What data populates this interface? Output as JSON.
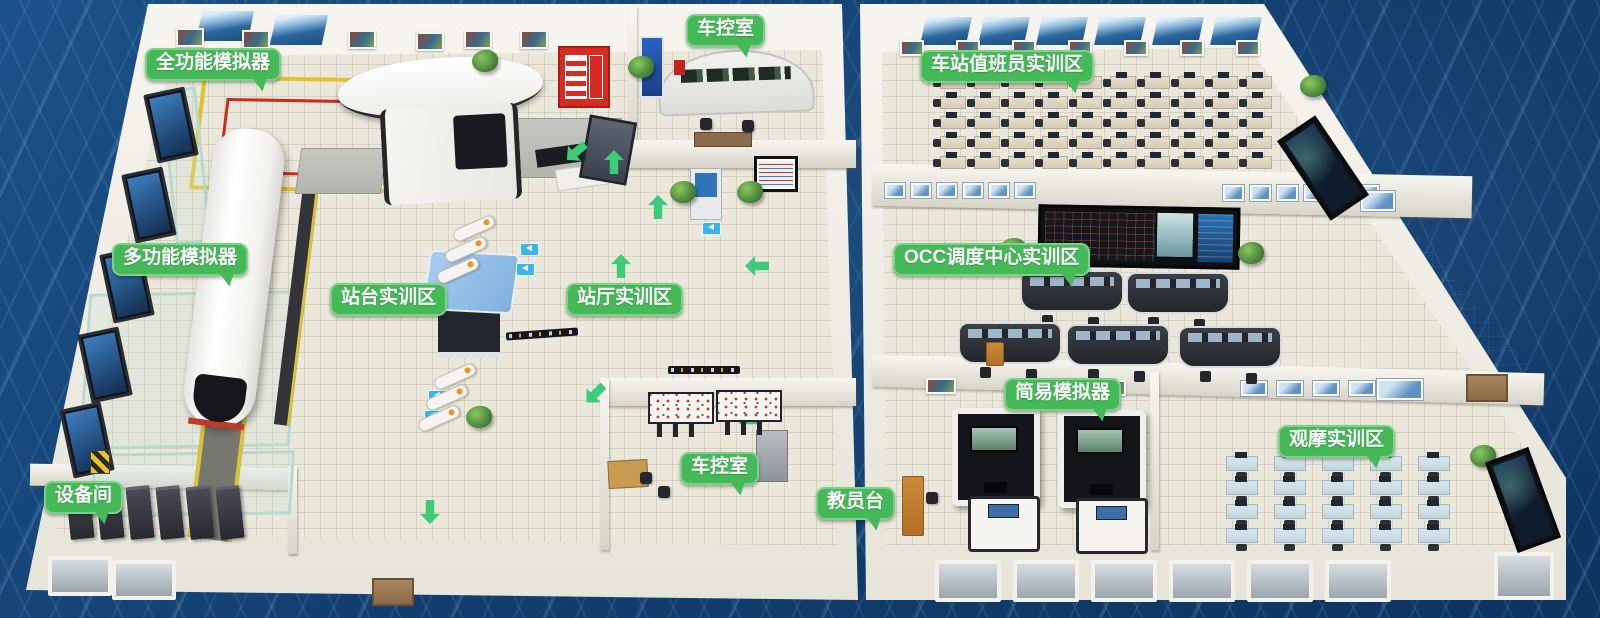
{
  "labels": {
    "full_function_simulator": "全功能模拟器",
    "vehicle_control_room_top": "车控室",
    "station_attendant_training_area": "车站值班员实训区",
    "multi_function_simulator": "多功能模拟器",
    "platform_training_area": "站台实训区",
    "station_hall_training_area": "站厅实训区",
    "occ_dispatch_training_area": "OCC调度中心实训区",
    "simple_simulator": "简易模拟器",
    "observation_training_area": "观摩实训区",
    "instructor_station": "教员台",
    "equipment_room": "设备间",
    "vehicle_control_room_bottom": "车控室",
    "service_center": "客服中心"
  },
  "colors": {
    "badge_green": "#45b857",
    "badge_border": "#7ed08a",
    "background_blue": "#123e6e",
    "floor_beige": "#ebe7da",
    "occ_floor_gray": "#9aa0a8",
    "marking_yellow": "#e2c22c",
    "marking_red": "#cb2a1e",
    "arrow_green": "#3ecb77",
    "sign_blue": "#3ab5ea"
  },
  "decor": {
    "items": [
      {
        "k": "arrow",
        "name": "flow-arrow-icon",
        "w": 20,
        "h": 24,
        "pts": [
          [
            566,
            140,
            -130
          ],
          [
            604,
            150,
            0
          ],
          [
            648,
            195,
            0
          ],
          [
            611,
            254,
            0
          ],
          [
            747,
            254,
            -90
          ],
          [
            585,
            382,
            -135
          ],
          [
            738,
            408,
            -90
          ],
          [
            420,
            500,
            180
          ]
        ]
      },
      {
        "k": "bluesign",
        "name": "direction-sign-icon",
        "w": 17,
        "h": 11,
        "pts": [
          [
            520,
            243
          ],
          [
            516,
            263
          ],
          [
            428,
            390
          ],
          [
            424,
            410
          ],
          [
            702,
            222
          ]
        ]
      },
      {
        "k": "gate",
        "name": "ticket-gate",
        "w": 42,
        "h": 11,
        "pts": [
          [
            452,
            222,
            -24
          ],
          [
            444,
            243,
            -24
          ],
          [
            436,
            264,
            -24
          ],
          [
            433,
            370,
            -24
          ],
          [
            425,
            391,
            -24
          ],
          [
            417,
            412,
            -24
          ]
        ]
      },
      {
        "k": "plant",
        "name": "plant",
        "w": 26,
        "h": 22,
        "pts": [
          [
            472,
            50
          ],
          [
            628,
            56
          ],
          [
            670,
            181
          ],
          [
            737,
            181
          ],
          [
            466,
            406
          ],
          [
            1300,
            75
          ],
          [
            1000,
            238
          ],
          [
            1238,
            242
          ],
          [
            1470,
            445
          ]
        ]
      },
      {
        "k": "tv",
        "name": "wall-screen",
        "w": 36,
        "h": 64,
        "pts": [
          [
            150,
            90,
            -12
          ],
          [
            128,
            170,
            -12
          ],
          [
            106,
            250,
            -12
          ],
          [
            84,
            330,
            -12
          ],
          [
            66,
            405,
            -12
          ]
        ]
      },
      {
        "k": "window",
        "name": "window",
        "w": 46,
        "h": 28,
        "grid": {
          "rows": 1,
          "cols": 6,
          "dx": 58,
          "dy": 0
        },
        "x": 920,
        "y": 14
      },
      {
        "k": "window",
        "name": "window",
        "w": 52,
        "h": 30,
        "pts": [
          [
            196,
            8
          ],
          [
            270,
            12
          ]
        ]
      },
      {
        "k": "photo",
        "name": "wall-photo",
        "w": 24,
        "h": 15,
        "pts": [
          [
            176,
            28
          ],
          [
            242,
            30
          ],
          [
            348,
            30
          ],
          [
            416,
            32
          ],
          [
            464,
            30
          ],
          [
            520,
            30
          ]
        ]
      },
      {
        "k": "photo",
        "name": "wall-photo",
        "w": 20,
        "h": 12,
        "grid": {
          "rows": 1,
          "cols": 7,
          "dx": 56,
          "dy": 0
        },
        "x": 900,
        "y": 40
      },
      {
        "k": "photo",
        "name": "wall-photo",
        "w": 26,
        "h": 12,
        "pts": [
          [
            926,
            378
          ],
          [
            1096,
            380
          ]
        ]
      },
      {
        "k": "poster",
        "name": "occ-wall-poster",
        "w": 20,
        "h": 15,
        "grid": {
          "rows": 1,
          "cols": 6,
          "dx": 26,
          "dy": 0
        },
        "x": 884,
        "y": 182
      },
      {
        "k": "poster",
        "name": "occ-wall-poster",
        "w": 21,
        "h": 16,
        "grid": {
          "rows": 1,
          "cols": 6,
          "dx": 27,
          "dy": 0
        },
        "x": 1222,
        "y": 184
      },
      {
        "k": "poster",
        "name": "occ-wall-poster",
        "w": 34,
        "h": 20,
        "pts": [
          [
            1360,
            190
          ]
        ]
      },
      {
        "k": "poster",
        "name": "obs-wall-poster",
        "w": 26,
        "h": 15,
        "grid": {
          "rows": 1,
          "cols": 5,
          "dx": 36,
          "dy": 0
        },
        "x": 1240,
        "y": 380
      },
      {
        "k": "poster",
        "name": "obs-wall-poster",
        "w": 46,
        "h": 21,
        "pts": [
          [
            1376,
            378
          ]
        ]
      },
      {
        "k": "deskA",
        "name": "workstation-desk",
        "w": 24,
        "h": 11,
        "grid": {
          "rows": 5,
          "cols": 10,
          "dx": 34,
          "dy": 20
        },
        "x": 940,
        "y": 76
      },
      {
        "k": "deskB",
        "name": "workstation-desk",
        "w": 30,
        "h": 13,
        "grid": {
          "rows": 4,
          "cols": 5,
          "dx": 48,
          "dy": 24
        },
        "x": 1226,
        "y": 456
      },
      {
        "k": "console",
        "name": "dispatch-console",
        "w": 100,
        "h": 38,
        "pts": [
          [
            1020,
            270
          ],
          [
            1126,
            272
          ],
          [
            958,
            322
          ],
          [
            1066,
            324
          ],
          [
            1178,
            326
          ]
        ]
      },
      {
        "k": "rack",
        "name": "server-rack",
        "w": 24,
        "h": 50,
        "grid": {
          "rows": 1,
          "cols": 6,
          "dx": 30,
          "dy": 0
        },
        "x": 68,
        "y": 486,
        "r": -6
      },
      {
        "k": "boothD",
        "name": "simulator-booth",
        "w": 76,
        "h": 86,
        "pts": [
          [
            952,
            408
          ],
          [
            1058,
            410
          ]
        ]
      },
      {
        "k": "boothW",
        "name": "simulator-booth",
        "w": 66,
        "h": 50,
        "pts": [
          [
            968,
            496
          ],
          [
            1076,
            498
          ]
        ]
      },
      {
        "k": "ibp",
        "name": "ibp-panel",
        "w": 62,
        "h": 28,
        "pts": [
          [
            648,
            392
          ],
          [
            716,
            390
          ]
        ]
      },
      {
        "k": "winB",
        "name": "exterior-window",
        "w": 56,
        "h": 32,
        "pts": [
          [
            48,
            556
          ],
          [
            112,
            560
          ]
        ]
      },
      {
        "k": "winB",
        "name": "exterior-window",
        "w": 58,
        "h": 34,
        "grid": {
          "rows": 1,
          "cols": 6,
          "dx": 78,
          "dy": 0
        },
        "x": 935,
        "y": 560
      },
      {
        "k": "winB",
        "name": "exterior-window",
        "w": 52,
        "h": 40,
        "pts": [
          [
            1494,
            552
          ]
        ]
      },
      {
        "k": "screenwall",
        "name": "display-screen",
        "w": 40,
        "h": 90,
        "pts": [
          [
            1300,
            120,
            -34
          ],
          [
            1500,
            452,
            -20
          ]
        ]
      },
      {
        "k": "signstrip",
        "name": "pis-sign",
        "w": 72,
        "h": 8,
        "pts": [
          [
            506,
            330,
            -4
          ],
          [
            668,
            366,
            0
          ]
        ]
      },
      {
        "k": "hazard",
        "name": "hazard-sign",
        "w": 18,
        "h": 22,
        "pts": [
          [
            90,
            450
          ]
        ]
      },
      {
        "k": "door",
        "name": "door",
        "w": 38,
        "h": 24,
        "pts": [
          [
            372,
            578
          ],
          [
            1466,
            374
          ]
        ]
      },
      {
        "k": "chair",
        "name": "chair",
        "w": 12,
        "h": 12,
        "pts": [
          [
            700,
            118
          ],
          [
            742,
            120
          ],
          [
            640,
            472
          ],
          [
            658,
            486
          ],
          [
            926,
            492
          ]
        ]
      },
      {
        "k": "wooddesk",
        "name": "instructor-desk",
        "w": 20,
        "h": 58,
        "pts": [
          [
            902,
            476
          ]
        ]
      },
      {
        "k": "wooddesk",
        "name": "podium",
        "w": 16,
        "h": 22,
        "pts": [
          [
            986,
            342
          ]
        ]
      }
    ]
  }
}
